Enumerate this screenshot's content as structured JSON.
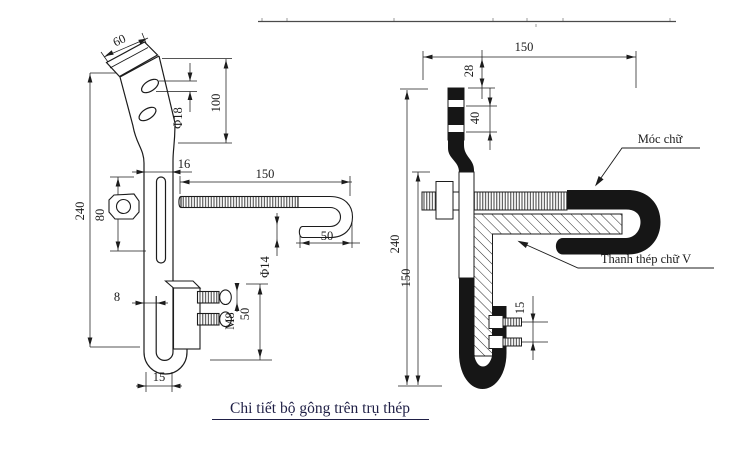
{
  "drawing": {
    "caption": "Chi tiết bộ gông trên trụ thép",
    "left_view": {
      "dims": {
        "tab_width": "60",
        "hole_dia": "Φ18",
        "upper_height": "100",
        "overall_height": "240",
        "slot_length": "80",
        "bar_width": "16",
        "bolt_length": "150",
        "hook_return": "50",
        "rod_dia": "Φ14",
        "thickness": "8",
        "bolt_thread": "M8",
        "plate_height": "50",
        "foot_width": "15"
      }
    },
    "right_view": {
      "dims": {
        "top_length": "150",
        "top_offset": "28",
        "hole_spacing": "40",
        "overall_height": "240",
        "lower_height": "150",
        "bolt_spacing": "15"
      },
      "labels": {
        "hook": "Móc chữ",
        "v_bar": "Thanh thép chữ V"
      }
    }
  }
}
